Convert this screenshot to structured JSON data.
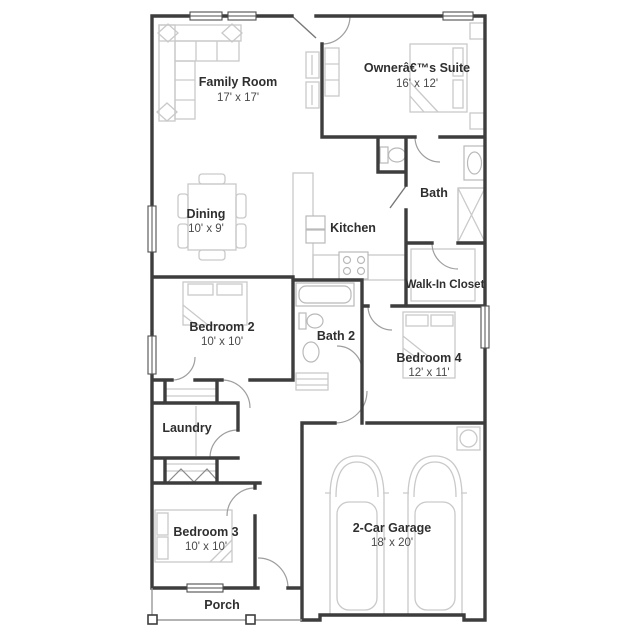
{
  "title": "Floor Plan",
  "colors": {
    "wall": "#3d3d3d",
    "furniture": "#c9c9c9",
    "door_swing": "#9e9e9e",
    "text": "#2f2f2f",
    "background": "#ffffff"
  },
  "rooms": [
    {
      "id": "family-room",
      "name": "Family Room",
      "dims": "17' x 17'"
    },
    {
      "id": "owners-suite",
      "name": "Ownerâ€™s Suite",
      "dims": "16' x 12'"
    },
    {
      "id": "dining",
      "name": "Dining",
      "dims": "10' x 9'"
    },
    {
      "id": "kitchen",
      "name": "Kitchen",
      "dims": ""
    },
    {
      "id": "bath",
      "name": "Bath",
      "dims": ""
    },
    {
      "id": "walk-in-closet",
      "name": "Walk-In Closet",
      "dims": ""
    },
    {
      "id": "bedroom-2",
      "name": "Bedroom 2",
      "dims": "10' x 10'"
    },
    {
      "id": "bath-2",
      "name": "Bath 2",
      "dims": ""
    },
    {
      "id": "bedroom-4",
      "name": "Bedroom 4",
      "dims": "12' x 11'"
    },
    {
      "id": "laundry",
      "name": "Laundry",
      "dims": ""
    },
    {
      "id": "bedroom-3",
      "name": "Bedroom 3",
      "dims": "10' x 10'"
    },
    {
      "id": "garage",
      "name": "2-Car Garage",
      "dims": "18' x 20'"
    },
    {
      "id": "porch",
      "name": "Porch",
      "dims": ""
    }
  ],
  "fixtures": [
    "sectional-sofa",
    "dining-table-with-chairs",
    "kitchen-counter",
    "kitchen-sink",
    "stove",
    "bed",
    "nightstand",
    "dresser",
    "toilet",
    "bathroom-sink",
    "bathtub",
    "shower",
    "closet-shelves",
    "bifold-doors",
    "car",
    "water-heater",
    "porch-posts"
  ]
}
